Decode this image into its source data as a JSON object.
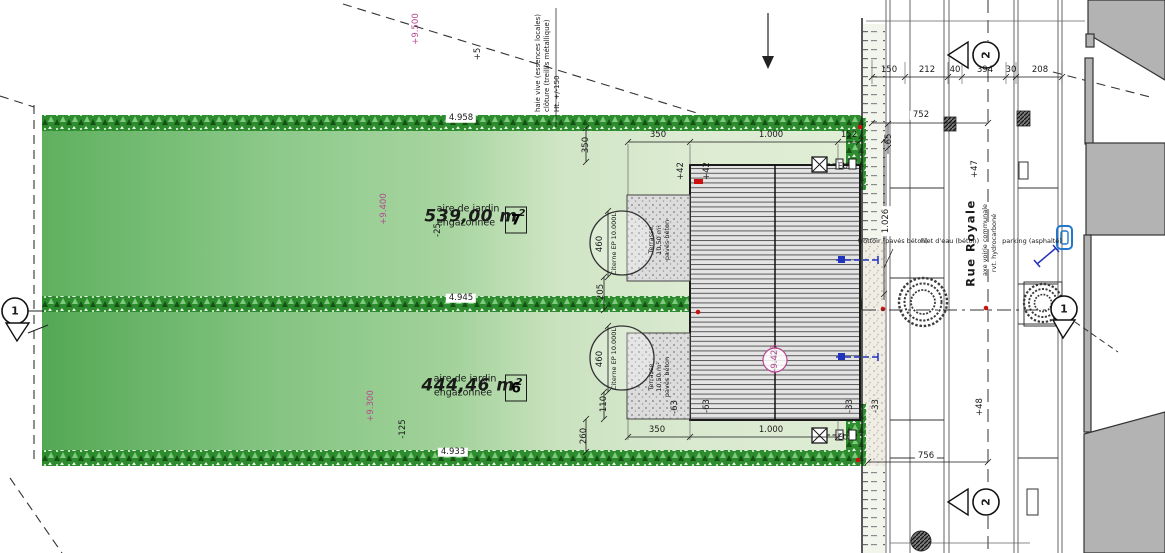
{
  "colors": {
    "parcel_green": "#7bbf79",
    "hedge_green": "#2d8c2d",
    "elevation_magenta": "#b4488e",
    "utility_blue": "#2233bb",
    "marker_red": "#cc1111",
    "neighbor_gray": "#b3b3b3"
  },
  "site": {
    "parcels": [
      {
        "number": "7",
        "area": "539,00 m²",
        "label1": "aire de jardin",
        "label2": "engazonnée",
        "elevation": "+9.400",
        "offset": "-25"
      },
      {
        "number": "6",
        "area": "444,46 m²",
        "label1": "aire de jardin",
        "label2": "engazonnée",
        "elevation": "+9.300",
        "offset": "-125"
      }
    ],
    "hedges": {
      "north": "4.958",
      "middle": "4.945",
      "south": "4.933"
    },
    "fence_note": [
      "haie vive (essences locales)",
      "clôture (treillis métallique)",
      "Ht. +/-150"
    ],
    "boundary": {
      "elevation": "+9.500",
      "offset": "+5"
    }
  },
  "building": {
    "dims": {
      "top": [
        "350",
        "1.000",
        "152"
      ],
      "bottom": [
        "350",
        "1.000"
      ],
      "left": [
        "350",
        "460",
        "205",
        "460",
        "110",
        "260"
      ]
    },
    "levels": {
      "plus1": "+42",
      "plus2": "+42",
      "minus1": "-63",
      "minus2": "-63",
      "minus3": "-33",
      "minus4": "-33",
      "roof": "+9.425"
    },
    "terrace": {
      "name": "Terrasse",
      "area": "10,50 m²",
      "material": "pavés béton"
    },
    "cistern": "Citerne EP 10.000L",
    "sewer": "EU"
  },
  "street": {
    "name": "Rue Royale",
    "axis_note": "axe voirie communale",
    "surface_note": "rvt. hydrocarboné",
    "sidewalk_note": "trottoir (pavés béton)",
    "gutter_note": "filet d'eau (béton)",
    "parking_note": "parking (asphalté)",
    "dim_row": [
      "150",
      "212",
      "40",
      "394",
      "30",
      "208"
    ],
    "dim_total_north": "752",
    "dim_total_south": "756",
    "dim_frontage": "1.026",
    "dim_verge": "65",
    "level_north": "+47",
    "level_south": "+48"
  },
  "markers": {
    "one": "1",
    "two": "2"
  }
}
